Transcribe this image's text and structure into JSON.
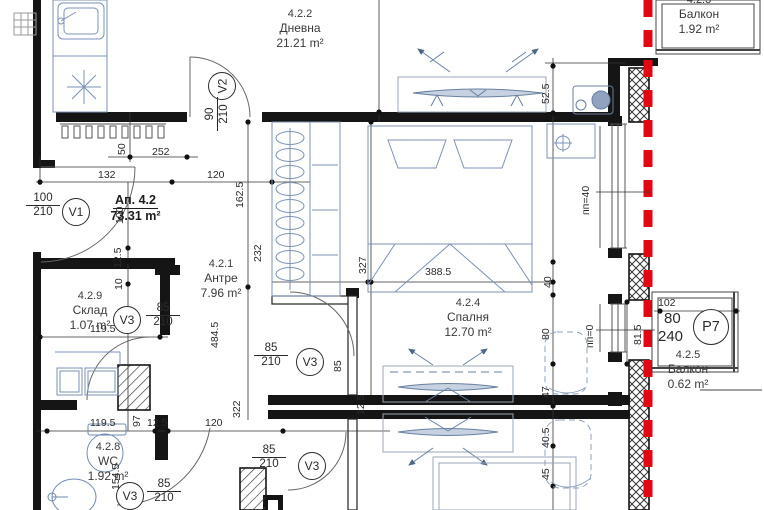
{
  "apartment": {
    "code": "Ап. 4.2",
    "area": "73.31 m²"
  },
  "rooms": {
    "dnevna": {
      "id": "4.2.2",
      "name": "Дневна",
      "area": "21.21 m²"
    },
    "balkon_top": {
      "id": "4.2.3",
      "name": "Балкон",
      "area": "1.92 m²"
    },
    "antre": {
      "id": "4.2.1",
      "name": "Антре",
      "area": "7.96 m²"
    },
    "sklad": {
      "id": "4.2.9",
      "name": "Склад",
      "area": "1.07 m²"
    },
    "spalnya": {
      "id": "4.2.4",
      "name": "Спалня",
      "area": "12.70 m²"
    },
    "wc": {
      "id": "4.2.8",
      "name": "WC",
      "area": "1.92 m²"
    },
    "balkon_bot": {
      "id": "4.2.5",
      "name": "Балкон",
      "area": "0.62 m²"
    }
  },
  "doors": {
    "v1": {
      "tag": "V1",
      "width": "100",
      "height": "210"
    },
    "v2": {
      "tag": "V2",
      "width": "90",
      "height": "210"
    },
    "v3": {
      "tag": "V3",
      "width": "85",
      "height": "210"
    },
    "p7": {
      "tag": "P7"
    }
  },
  "levels": {
    "pp40": "пп=40",
    "pp0": "пп=0"
  },
  "dims": {
    "d50": "50",
    "d252": "252",
    "d132": "132",
    "d120_top": "120",
    "d100": "100",
    "d12_5_left": "12.5",
    "d10": "10",
    "d162_5": "162.5",
    "d232": "232",
    "d327": "327",
    "d388_5": "388.5",
    "d52_5": "52.5",
    "d40": "40",
    "d80": "80",
    "d47": "47",
    "d40_5": "40.5",
    "d45": "45",
    "d484_5": "484.5",
    "d322": "322",
    "d85": "85",
    "d119_5_a": "119.5",
    "d119_5_b": "119.5",
    "d12_5_b": "12.5",
    "d120_bot": "120",
    "d97": "97",
    "d154_5": "154.5",
    "d12_5_c": "12.5",
    "d102": "102",
    "d80_b": "80",
    "d240": "240",
    "d81_5": "81.5"
  }
}
